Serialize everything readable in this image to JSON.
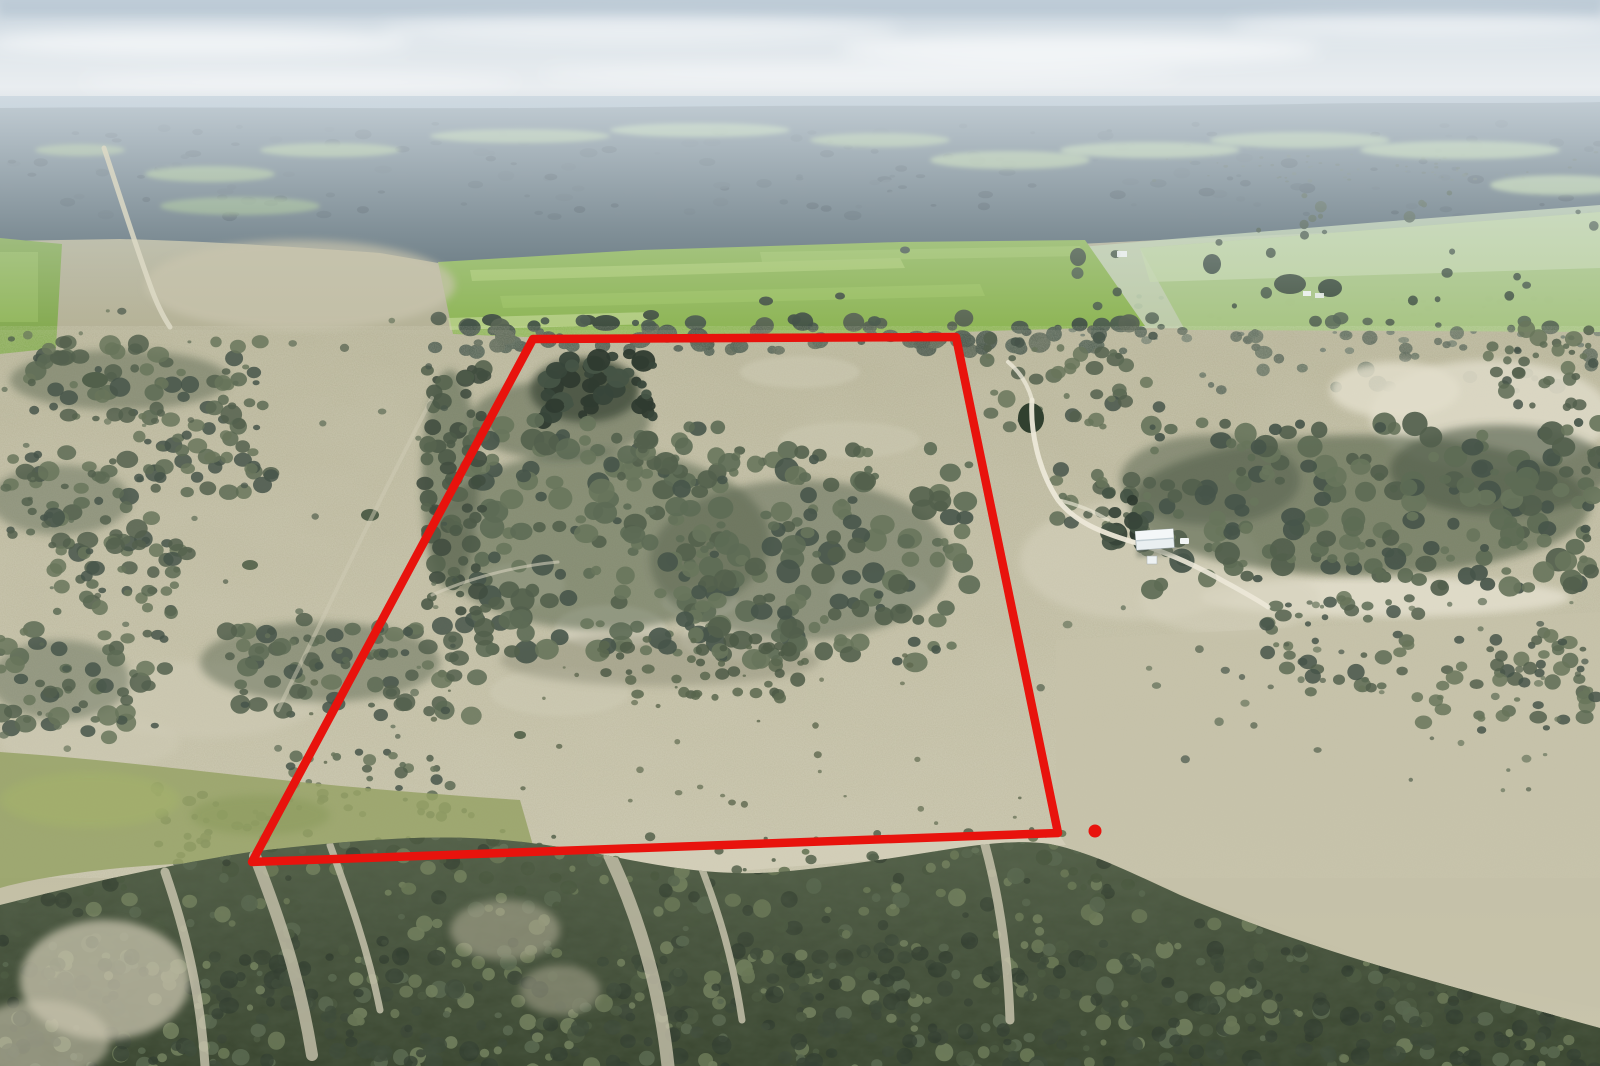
{
  "photo": {
    "kind": "aerial-property-photograph"
  },
  "boundary": {
    "points": "533,339 956,337 1058,833 252,862",
    "color": "#e8130d",
    "stroke_width": "8.5",
    "marker": {
      "cx": "1095",
      "cy": "831",
      "r": "6.5"
    }
  },
  "palette": {
    "sky_top": "#c3d0da",
    "sky_glow": "#e9edf0",
    "horizon_haze": "#879aa6",
    "distant_forest": "#54666e",
    "field_green": "#8cb452",
    "field_green_light": "#aac96e",
    "field_green_pale": "#c2d5a6",
    "ground_olive": "#b7b39a",
    "sand_pale": "#dcd8c4",
    "scrub_dark": "#53604d",
    "forest_dark": "#46523c",
    "track_white": "#ece8d8",
    "shed_roof": "#e9eff1",
    "boundary_red": "#e8130d"
  }
}
